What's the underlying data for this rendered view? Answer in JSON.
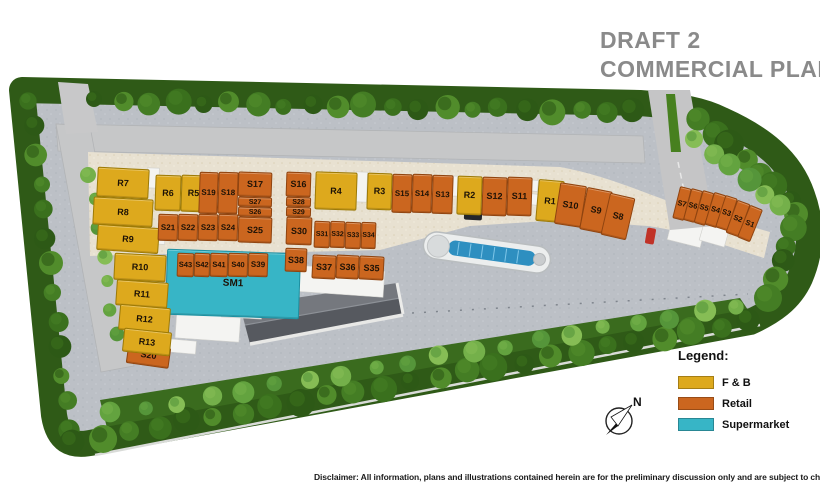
{
  "title": {
    "line1": "DRAFT 2",
    "line2": "COMMERCIAL PLAN"
  },
  "legend": {
    "heading": "Legend:",
    "items": [
      {
        "label": "F & B",
        "type": "fnb",
        "color": "#dda91d"
      },
      {
        "label": "Retail",
        "type": "retail",
        "color": "#cb661f"
      },
      {
        "label": "Supermarket",
        "type": "supermarket",
        "color": "#37b5c6"
      }
    ]
  },
  "compass": {
    "label": "N"
  },
  "disclaimer": "Disclaimer: All information, plans and illustrations contained herein are for the preliminary discussion only and are subject to change at all times.",
  "units": [
    {
      "label": "R7",
      "type": "fnb",
      "x": 97,
      "y": 168,
      "w": 52,
      "h": 30,
      "r": 3
    },
    {
      "label": "R8",
      "type": "fnb",
      "x": 93,
      "y": 198,
      "w": 60,
      "h": 28,
      "r": 3
    },
    {
      "label": "R9",
      "type": "fnb",
      "x": 97,
      "y": 226,
      "w": 62,
      "h": 26,
      "r": 4
    },
    {
      "label": "R6",
      "type": "fnb",
      "x": 155,
      "y": 175,
      "w": 26,
      "h": 36,
      "r": 2
    },
    {
      "label": "R5",
      "type": "fnb",
      "x": 181,
      "y": 175,
      "w": 25,
      "h": 37,
      "r": 2
    },
    {
      "label": "S19",
      "type": "retail",
      "x": 199,
      "y": 172,
      "w": 19,
      "h": 42,
      "r": 2,
      "fs": 8
    },
    {
      "label": "S18",
      "type": "retail",
      "x": 218,
      "y": 172,
      "w": 20,
      "h": 42,
      "r": 2,
      "fs": 8
    },
    {
      "label": "S17",
      "type": "retail",
      "x": 238,
      "y": 172,
      "w": 34,
      "h": 25,
      "r": 2
    },
    {
      "label": "S27",
      "type": "retail",
      "x": 238,
      "y": 197,
      "w": 34,
      "h": 10,
      "r": 2,
      "fs": 7
    },
    {
      "label": "S26",
      "type": "retail",
      "x": 238,
      "y": 207,
      "w": 34,
      "h": 10,
      "r": 2,
      "fs": 7
    },
    {
      "label": "S21",
      "type": "retail",
      "x": 158,
      "y": 214,
      "w": 20,
      "h": 27,
      "r": 2,
      "fs": 8
    },
    {
      "label": "S22",
      "type": "retail",
      "x": 178,
      "y": 214,
      "w": 20,
      "h": 27,
      "r": 2,
      "fs": 8
    },
    {
      "label": "S23",
      "type": "retail",
      "x": 198,
      "y": 214,
      "w": 20,
      "h": 27,
      "r": 2,
      "fs": 8
    },
    {
      "label": "S24",
      "type": "retail",
      "x": 218,
      "y": 214,
      "w": 20,
      "h": 27,
      "r": 2,
      "fs": 8
    },
    {
      "label": "S25",
      "type": "retail",
      "x": 238,
      "y": 217,
      "w": 34,
      "h": 26,
      "r": 2
    },
    {
      "label": "S16",
      "type": "retail",
      "x": 286,
      "y": 172,
      "w": 25,
      "h": 25,
      "r": 2
    },
    {
      "label": "S28",
      "type": "retail",
      "x": 286,
      "y": 197,
      "w": 25,
      "h": 10,
      "r": 2,
      "fs": 7
    },
    {
      "label": "S29",
      "type": "retail",
      "x": 286,
      "y": 207,
      "w": 25,
      "h": 10,
      "r": 2,
      "fs": 7
    },
    {
      "label": "S30",
      "type": "retail",
      "x": 286,
      "y": 217,
      "w": 26,
      "h": 28,
      "r": 2
    },
    {
      "label": "S31",
      "type": "retail",
      "x": 314,
      "y": 221,
      "w": 16,
      "h": 27,
      "r": 2,
      "fs": 7
    },
    {
      "label": "S32",
      "type": "retail",
      "x": 330,
      "y": 221,
      "w": 15,
      "h": 27,
      "r": 2,
      "fs": 7
    },
    {
      "label": "S33",
      "type": "retail",
      "x": 345,
      "y": 222,
      "w": 16,
      "h": 27,
      "r": 2,
      "fs": 7
    },
    {
      "label": "S34",
      "type": "retail",
      "x": 361,
      "y": 222,
      "w": 15,
      "h": 27,
      "r": 2,
      "fs": 7
    },
    {
      "label": "R4",
      "type": "fnb",
      "x": 315,
      "y": 172,
      "w": 42,
      "h": 38,
      "r": 2
    },
    {
      "label": "R3",
      "type": "fnb",
      "x": 367,
      "y": 173,
      "w": 25,
      "h": 37,
      "r": 2
    },
    {
      "label": "S15",
      "type": "retail",
      "x": 392,
      "y": 174,
      "w": 20,
      "h": 39,
      "r": 2,
      "fs": 8
    },
    {
      "label": "S14",
      "type": "retail",
      "x": 412,
      "y": 174,
      "w": 20,
      "h": 39,
      "r": 2,
      "fs": 8
    },
    {
      "label": "S13",
      "type": "retail",
      "x": 432,
      "y": 175,
      "w": 21,
      "h": 39,
      "r": 2,
      "fs": 8
    },
    {
      "label": "R2",
      "type": "fnb",
      "x": 457,
      "y": 176,
      "w": 25,
      "h": 39,
      "r": 2
    },
    {
      "label": "S12",
      "type": "retail",
      "x": 482,
      "y": 177,
      "w": 25,
      "h": 39,
      "r": 2
    },
    {
      "label": "S11",
      "type": "retail",
      "x": 507,
      "y": 177,
      "w": 25,
      "h": 39,
      "r": 2
    },
    {
      "label": "R1",
      "type": "fnb",
      "x": 537,
      "y": 180,
      "w": 26,
      "h": 42,
      "r": 5
    },
    {
      "label": "S10",
      "type": "retail",
      "x": 557,
      "y": 184,
      "w": 27,
      "h": 42,
      "r": 9
    },
    {
      "label": "S9",
      "type": "retail",
      "x": 583,
      "y": 189,
      "w": 26,
      "h": 43,
      "r": 11
    },
    {
      "label": "S8",
      "type": "retail",
      "x": 605,
      "y": 195,
      "w": 26,
      "h": 43,
      "r": 13
    },
    {
      "label": "S7",
      "type": "retail",
      "x": 676,
      "y": 187,
      "w": 12,
      "h": 33,
      "r": 14,
      "fs": 7.5
    },
    {
      "label": "S6",
      "type": "retail",
      "x": 687,
      "y": 189,
      "w": 12,
      "h": 33,
      "r": 15,
      "fs": 7.5
    },
    {
      "label": "S5",
      "type": "retail",
      "x": 698,
      "y": 191,
      "w": 12,
      "h": 34,
      "r": 16,
      "fs": 7.5
    },
    {
      "label": "S4",
      "type": "retail",
      "x": 709,
      "y": 193,
      "w": 13,
      "h": 34,
      "r": 17,
      "fs": 7.5
    },
    {
      "label": "S3",
      "type": "retail",
      "x": 720,
      "y": 196,
      "w": 13,
      "h": 34,
      "r": 18,
      "fs": 7.5
    },
    {
      "label": "S2",
      "type": "retail",
      "x": 731,
      "y": 201,
      "w": 14,
      "h": 35,
      "r": 20,
      "fs": 7.5
    },
    {
      "label": "S1",
      "type": "retail",
      "x": 743,
      "y": 206,
      "w": 14,
      "h": 35,
      "r": 22,
      "fs": 7.5
    },
    {
      "label": "SM1",
      "type": "supermarket",
      "x": 166,
      "y": 251,
      "w": 134,
      "h": 66,
      "r": 2,
      "fs": 10
    },
    {
      "label": "S43",
      "type": "retail",
      "x": 177,
      "y": 253,
      "w": 17,
      "h": 24,
      "r": 2,
      "fs": 7.5
    },
    {
      "label": "S42",
      "type": "retail",
      "x": 194,
      "y": 253,
      "w": 16,
      "h": 24,
      "r": 2,
      "fs": 7.5
    },
    {
      "label": "S41",
      "type": "retail",
      "x": 210,
      "y": 253,
      "w": 18,
      "h": 24,
      "r": 2,
      "fs": 7.5
    },
    {
      "label": "S40",
      "type": "retail",
      "x": 228,
      "y": 253,
      "w": 20,
      "h": 24,
      "r": 2,
      "fs": 7.5
    },
    {
      "label": "S39",
      "type": "retail",
      "x": 248,
      "y": 253,
      "w": 20,
      "h": 24,
      "r": 2,
      "fs": 8
    },
    {
      "label": "S38",
      "type": "retail",
      "x": 285,
      "y": 248,
      "w": 22,
      "h": 24,
      "r": 2
    },
    {
      "label": "S37",
      "type": "retail",
      "x": 312,
      "y": 255,
      "w": 24,
      "h": 24,
      "r": 3
    },
    {
      "label": "S36",
      "type": "retail",
      "x": 336,
      "y": 255,
      "w": 23,
      "h": 24,
      "r": 3
    },
    {
      "label": "S35",
      "type": "retail",
      "x": 359,
      "y": 256,
      "w": 25,
      "h": 24,
      "r": 3
    },
    {
      "label": "S20",
      "type": "retail",
      "x": 127,
      "y": 345,
      "w": 43,
      "h": 21,
      "r": 8
    },
    {
      "label": "R10",
      "type": "fnb",
      "x": 114,
      "y": 254,
      "w": 52,
      "h": 27,
      "r": 3
    },
    {
      "label": "R11",
      "type": "fnb",
      "x": 116,
      "y": 281,
      "w": 52,
      "h": 26,
      "r": 4
    },
    {
      "label": "R12",
      "type": "fnb",
      "x": 119,
      "y": 306,
      "w": 51,
      "h": 26,
      "r": 5
    },
    {
      "label": "R13",
      "type": "fnb",
      "x": 123,
      "y": 330,
      "w": 48,
      "h": 24,
      "r": 6
    }
  ]
}
